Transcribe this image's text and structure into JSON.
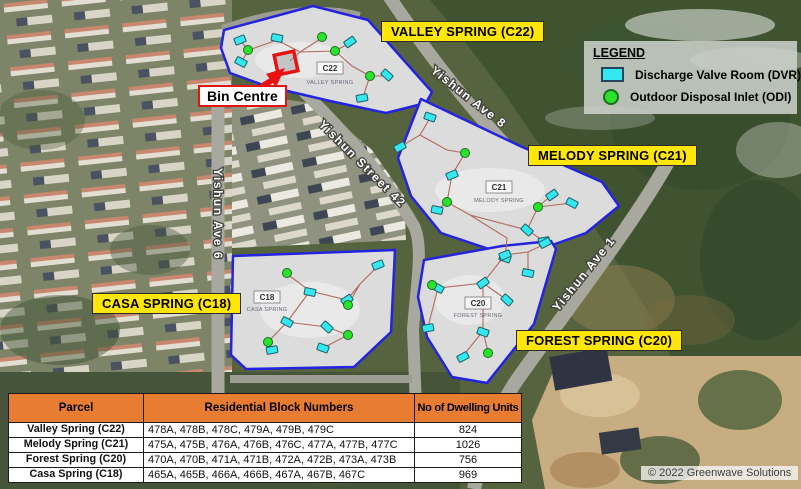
{
  "map": {
    "area_labels": [
      {
        "id": "valley",
        "label": "VALLEY SPRING (C22)"
      },
      {
        "id": "melody",
        "label": "MELODY SPRING (C21)"
      },
      {
        "id": "casa",
        "label": "CASA SPRING (C18)"
      },
      {
        "id": "forest",
        "label": "FOREST SPRING (C20)"
      }
    ],
    "bin_centre_label": "Bin Centre",
    "parcel_tags": [
      {
        "code": "C22",
        "name": "VALLEY SPRING"
      },
      {
        "code": "C21",
        "name": "MELODY SPRING"
      },
      {
        "code": "C18",
        "name": "CASA SPRING"
      },
      {
        "code": "C20",
        "name": "FOREST SPRING"
      }
    ],
    "road_labels": [
      "Yishun Ave 8",
      "Yishun Street 42",
      "Yishun Ave 6",
      "Yishun Ave 1"
    ],
    "outline_color": "#2323e0",
    "markers": {
      "dvr": [
        [
          240,
          40
        ],
        [
          277,
          38
        ],
        [
          350,
          42
        ],
        [
          241,
          62
        ],
        [
          387,
          75
        ],
        [
          362,
          98
        ],
        [
          430,
          117
        ],
        [
          400,
          147
        ],
        [
          452,
          175
        ],
        [
          437,
          210
        ],
        [
          552,
          195
        ],
        [
          572,
          203
        ],
        [
          527,
          230
        ],
        [
          544,
          241
        ],
        [
          505,
          258
        ],
        [
          545,
          243
        ],
        [
          505,
          255
        ],
        [
          528,
          273
        ],
        [
          483,
          283
        ],
        [
          438,
          288
        ],
        [
          507,
          300
        ],
        [
          428,
          328
        ],
        [
          483,
          332
        ],
        [
          463,
          357
        ],
        [
          378,
          265
        ],
        [
          310,
          292
        ],
        [
          347,
          300
        ],
        [
          287,
          322
        ],
        [
          327,
          327
        ],
        [
          272,
          350
        ],
        [
          323,
          348
        ]
      ],
      "odi": [
        [
          248,
          50
        ],
        [
          322,
          37
        ],
        [
          335,
          51
        ],
        [
          370,
          76
        ],
        [
          465,
          153
        ],
        [
          447,
          202
        ],
        [
          538,
          207
        ],
        [
          432,
          285
        ],
        [
          488,
          353
        ],
        [
          287,
          273
        ],
        [
          348,
          305
        ],
        [
          348,
          335
        ],
        [
          268,
          342
        ]
      ]
    }
  },
  "legend": {
    "title": "LEGEND",
    "items": [
      {
        "symbol": "dvr-swatch",
        "label": "Discharge Valve Room (DVR)",
        "color": "#35e8ef"
      },
      {
        "symbol": "odi-swatch",
        "label": "Outdoor Disposal Inlet (ODI)",
        "color": "#29e32a"
      }
    ]
  },
  "table": {
    "header_bg": "#e87d31",
    "headers": [
      "Parcel",
      "Residential Block Numbers",
      "No of Dwelling Units"
    ],
    "rows": [
      {
        "parcel": "Valley Spring (C22)",
        "blocks": "478A, 478B, 478C, 479A, 479B, 479C",
        "units": "824"
      },
      {
        "parcel": "Melody Spring (C21)",
        "blocks": "475A, 475B, 476A, 476B, 476C, 477A, 477B, 477C",
        "units": "1026"
      },
      {
        "parcel": "Forest Spring (C20)",
        "blocks": "470A, 470B, 471A, 471B, 472A, 472B, 473A, 473B",
        "units": "756"
      },
      {
        "parcel": "Casa Spring (C18)",
        "blocks": "465A, 465B, 466A, 466B, 467A, 467B, 467C",
        "units": "969"
      }
    ]
  },
  "copyright": "© 2022 Greenwave Solutions"
}
